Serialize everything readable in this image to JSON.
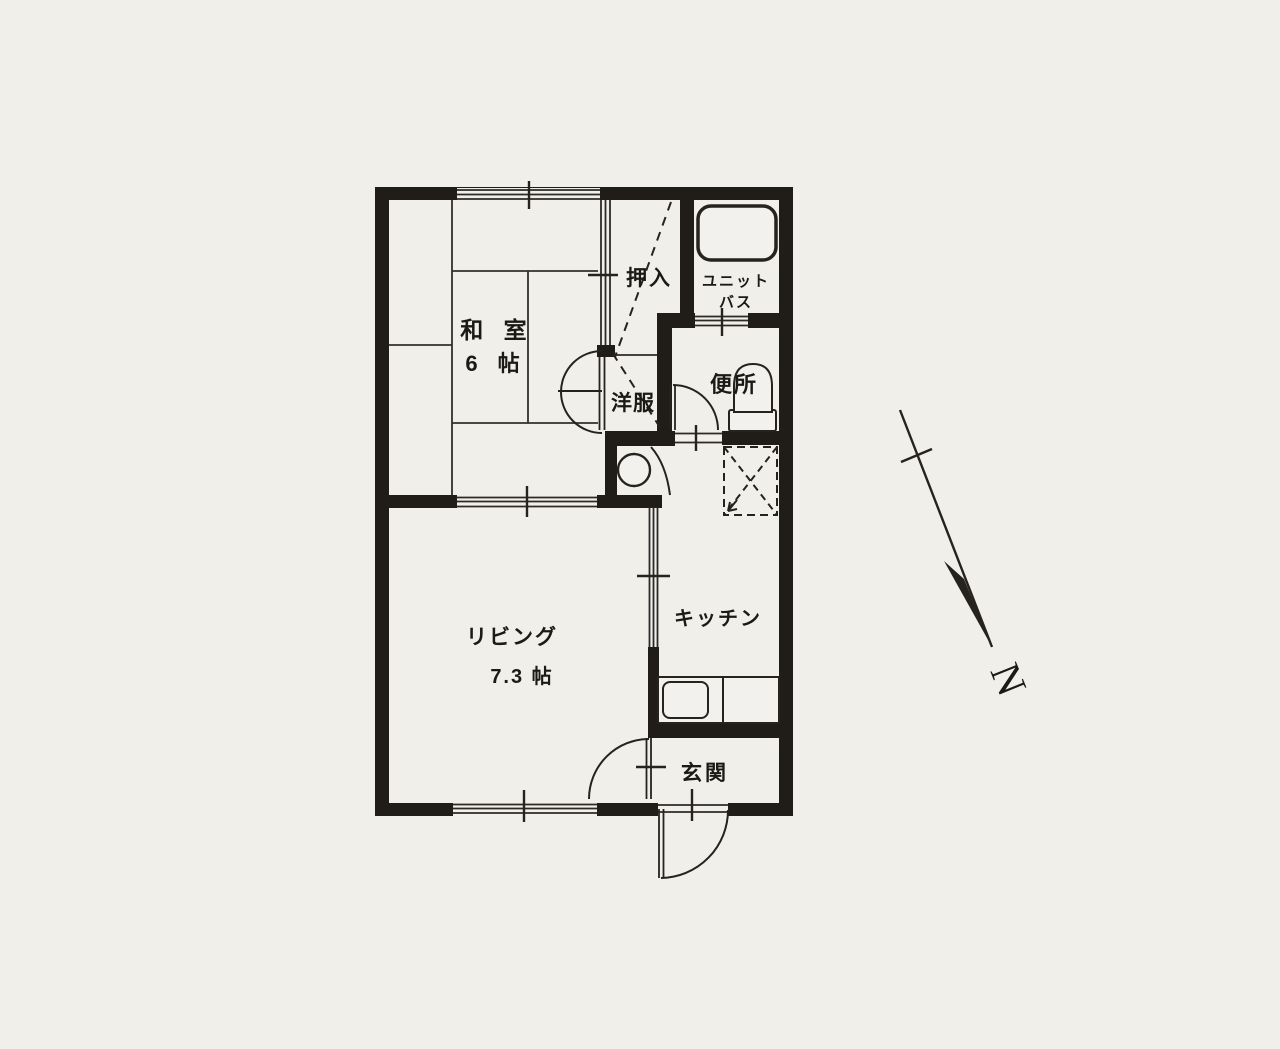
{
  "floor_plan": {
    "rooms": {
      "washitsu": {
        "name": "和 室",
        "size": "6 帖"
      },
      "living": {
        "name": "リビング",
        "size": "7.3 帖"
      },
      "kitchen": {
        "name": "キッチン"
      },
      "entrance": {
        "name": "玄関"
      },
      "oshiire": {
        "name": "押入"
      },
      "closet": {
        "name": "洋服"
      },
      "unit_bath": {
        "name_line1": "ユニット",
        "name_line2": "バス"
      },
      "toilet": {
        "name": "便所"
      }
    },
    "compass": {
      "label": "N"
    },
    "colors": {
      "paper": "#f1efea",
      "wall": "#201d19",
      "line": "#33302b"
    }
  }
}
